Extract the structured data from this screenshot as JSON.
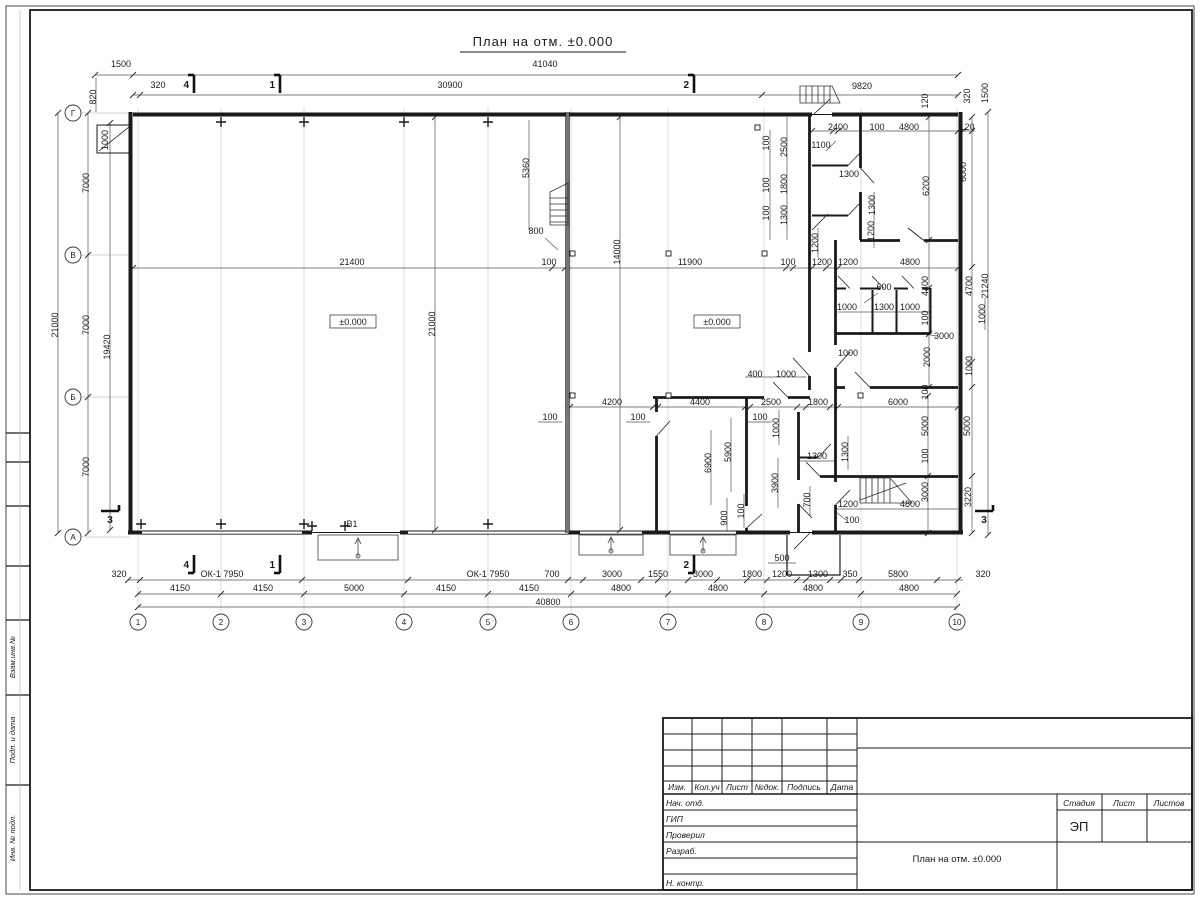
{
  "title": "План на отм. ±0.000",
  "colors": {
    "wall": "#1a1a1a",
    "dim_line": "#555555",
    "axis_line": "#c8c8c8",
    "hatch_wall": "#777777",
    "background": "#ffffff"
  },
  "level_labels": [
    {
      "t": "±0.000",
      "x": 353,
      "y": 324
    },
    {
      "t": "±0.000",
      "x": 717,
      "y": 324
    }
  ],
  "axes": {
    "columns": [
      {
        "label": "1",
        "x": 138
      },
      {
        "label": "2",
        "x": 221
      },
      {
        "label": "3",
        "x": 304
      },
      {
        "label": "4",
        "x": 404
      },
      {
        "label": "5",
        "x": 488
      },
      {
        "label": "6",
        "x": 571
      },
      {
        "label": "7",
        "x": 668
      },
      {
        "label": "8",
        "x": 764
      },
      {
        "label": "9",
        "x": 861
      },
      {
        "label": "10",
        "x": 957
      }
    ],
    "rows": [
      {
        "label": "Г",
        "y": 113
      },
      {
        "label": "В",
        "y": 255
      },
      {
        "label": "Б",
        "y": 397
      },
      {
        "label": "А",
        "y": 537
      }
    ]
  },
  "section_marks": [
    {
      "t": "4",
      "x": 186,
      "y": 86,
      "dir": "t"
    },
    {
      "t": "1",
      "x": 272,
      "y": 86,
      "dir": "t"
    },
    {
      "t": "2",
      "x": 686,
      "y": 86,
      "dir": "t"
    },
    {
      "t": "4",
      "x": 186,
      "y": 566,
      "dir": "b"
    },
    {
      "t": "1",
      "x": 272,
      "y": 566,
      "dir": "b"
    },
    {
      "t": "2",
      "x": 686,
      "y": 566,
      "dir": "b"
    },
    {
      "t": "3",
      "x": 110,
      "y": 514,
      "dir": "l"
    },
    {
      "t": "3",
      "x": 984,
      "y": 514,
      "dir": "r"
    }
  ],
  "dim_labels": [
    {
      "t": "1500",
      "x": 121,
      "y": 67
    },
    {
      "t": "41040",
      "x": 545,
      "y": 67
    },
    {
      "t": "320",
      "x": 158,
      "y": 88
    },
    {
      "t": "30900",
      "x": 450,
      "y": 88
    },
    {
      "t": "9820",
      "x": 862,
      "y": 89
    },
    {
      "t": "820",
      "x": 96,
      "y": 97,
      "r": 1
    },
    {
      "t": "120",
      "x": 928,
      "y": 101,
      "r": 1
    },
    {
      "t": "320",
      "x": 970,
      "y": 96,
      "r": 1
    },
    {
      "t": "1500",
      "x": 988,
      "y": 93,
      "r": 1
    },
    {
      "t": "2400",
      "x": 838,
      "y": 130
    },
    {
      "t": "100",
      "x": 877,
      "y": 130
    },
    {
      "t": "4800",
      "x": 909,
      "y": 130
    },
    {
      "t": "120",
      "x": 967,
      "y": 130
    },
    {
      "t": "1100",
      "x": 821,
      "y": 148
    },
    {
      "t": "100",
      "x": 769,
      "y": 143,
      "r": 1
    },
    {
      "t": "2500",
      "x": 787,
      "y": 147,
      "r": 1
    },
    {
      "t": "1300",
      "x": 849,
      "y": 177
    },
    {
      "t": "100",
      "x": 769,
      "y": 185,
      "r": 1
    },
    {
      "t": "1800",
      "x": 787,
      "y": 184,
      "r": 1
    },
    {
      "t": "100",
      "x": 769,
      "y": 213,
      "r": 1
    },
    {
      "t": "1300",
      "x": 787,
      "y": 215,
      "r": 1
    },
    {
      "t": "6200",
      "x": 929,
      "y": 186,
      "r": 1
    },
    {
      "t": "6000",
      "x": 966,
      "y": 172,
      "r": 1
    },
    {
      "t": "1300",
      "x": 875,
      "y": 205,
      "r": 1
    },
    {
      "t": "1200",
      "x": 874,
      "y": 231,
      "r": 1
    },
    {
      "t": "1200",
      "x": 818,
      "y": 243,
      "r": 1
    },
    {
      "t": "21400",
      "x": 352,
      "y": 265
    },
    {
      "t": "800",
      "x": 536,
      "y": 234
    },
    {
      "t": "100",
      "x": 549,
      "y": 265
    },
    {
      "t": "14000",
      "x": 620,
      "y": 252,
      "r": 1
    },
    {
      "t": "11900",
      "x": 690,
      "y": 265
    },
    {
      "t": "100",
      "x": 788,
      "y": 265
    },
    {
      "t": "1200",
      "x": 822,
      "y": 265
    },
    {
      "t": "1200",
      "x": 848,
      "y": 265
    },
    {
      "t": "4800",
      "x": 910,
      "y": 265
    },
    {
      "t": "5360",
      "x": 529,
      "y": 168,
      "r": 1
    },
    {
      "t": "21000",
      "x": 435,
      "y": 324,
      "r": 1
    },
    {
      "t": "4400",
      "x": 928,
      "y": 286,
      "r": 1
    },
    {
      "t": "4700",
      "x": 972,
      "y": 286,
      "r": 1
    },
    {
      "t": "21240",
      "x": 988,
      "y": 286,
      "r": 1
    },
    {
      "t": "600",
      "x": 884,
      "y": 290
    },
    {
      "t": "1000",
      "x": 847,
      "y": 310
    },
    {
      "t": "1300",
      "x": 884,
      "y": 310
    },
    {
      "t": "1000",
      "x": 910,
      "y": 310
    },
    {
      "t": "100",
      "x": 928,
      "y": 318,
      "r": 1
    },
    {
      "t": "1000",
      "x": 985,
      "y": 314,
      "r": 1
    },
    {
      "t": "3000",
      "x": 944,
      "y": 339
    },
    {
      "t": "2000",
      "x": 930,
      "y": 357,
      "r": 1
    },
    {
      "t": "1000",
      "x": 972,
      "y": 366,
      "r": 1
    },
    {
      "t": "1000",
      "x": 848,
      "y": 356
    },
    {
      "t": "100",
      "x": 928,
      "y": 392,
      "r": 1
    },
    {
      "t": "400",
      "x": 755,
      "y": 377
    },
    {
      "t": "1000",
      "x": 786,
      "y": 377
    },
    {
      "t": "4200",
      "x": 612,
      "y": 405
    },
    {
      "t": "4400",
      "x": 700,
      "y": 405
    },
    {
      "t": "2500",
      "x": 771,
      "y": 405
    },
    {
      "t": "1800",
      "x": 818,
      "y": 405
    },
    {
      "t": "6000",
      "x": 898,
      "y": 405
    },
    {
      "t": "100",
      "x": 550,
      "y": 420
    },
    {
      "t": "100",
      "x": 638,
      "y": 420
    },
    {
      "t": "100",
      "x": 760,
      "y": 420
    },
    {
      "t": "1000",
      "x": 779,
      "y": 428,
      "r": 1
    },
    {
      "t": "5000",
      "x": 928,
      "y": 426,
      "r": 1
    },
    {
      "t": "5000",
      "x": 970,
      "y": 426,
      "r": 1
    },
    {
      "t": "6900",
      "x": 711,
      "y": 463,
      "r": 1
    },
    {
      "t": "5900",
      "x": 731,
      "y": 452,
      "r": 1
    },
    {
      "t": "1300",
      "x": 817,
      "y": 459
    },
    {
      "t": "1300",
      "x": 848,
      "y": 452,
      "r": 1
    },
    {
      "t": "100",
      "x": 928,
      "y": 456,
      "r": 1
    },
    {
      "t": "3900",
      "x": 778,
      "y": 483,
      "r": 1
    },
    {
      "t": "700",
      "x": 810,
      "y": 500,
      "r": 1
    },
    {
      "t": "900",
      "x": 727,
      "y": 518,
      "r": 1
    },
    {
      "t": "100",
      "x": 744,
      "y": 511,
      "r": 1
    },
    {
      "t": "1200",
      "x": 848,
      "y": 507
    },
    {
      "t": "100",
      "x": 852,
      "y": 523
    },
    {
      "t": "4800",
      "x": 910,
      "y": 507
    },
    {
      "t": "3000",
      "x": 928,
      "y": 492,
      "r": 1
    },
    {
      "t": "3220",
      "x": 971,
      "y": 497,
      "r": 1
    },
    {
      "t": "500",
      "x": 782,
      "y": 561
    },
    {
      "t": "7000",
      "x": 89,
      "y": 183,
      "r": 1
    },
    {
      "t": "7000",
      "x": 89,
      "y": 325,
      "r": 1
    },
    {
      "t": "7000",
      "x": 89,
      "y": 467,
      "r": 1
    },
    {
      "t": "21000",
      "x": 58,
      "y": 325,
      "r": 1
    },
    {
      "t": "19420",
      "x": 110,
      "y": 347,
      "r": 1
    },
    {
      "t": "1000",
      "x": 108,
      "y": 140,
      "r": 1
    },
    {
      "t": "В1",
      "x": 352,
      "y": 527
    },
    {
      "t": "320",
      "x": 119,
      "y": 577
    },
    {
      "t": "ОК-1 7950",
      "x": 222,
      "y": 577
    },
    {
      "t": "ОК-1 7950",
      "x": 488,
      "y": 577
    },
    {
      "t": "700",
      "x": 552,
      "y": 577
    },
    {
      "t": "3000",
      "x": 612,
      "y": 577
    },
    {
      "t": "1550",
      "x": 658,
      "y": 577
    },
    {
      "t": "3000",
      "x": 703,
      "y": 577
    },
    {
      "t": "1800",
      "x": 752,
      "y": 577
    },
    {
      "t": "1200",
      "x": 782,
      "y": 577
    },
    {
      "t": "1300",
      "x": 818,
      "y": 577
    },
    {
      "t": "350",
      "x": 850,
      "y": 577
    },
    {
      "t": "5800",
      "x": 898,
      "y": 577
    },
    {
      "t": "320",
      "x": 983,
      "y": 577
    },
    {
      "t": "4150",
      "x": 180,
      "y": 591
    },
    {
      "t": "4150",
      "x": 263,
      "y": 591
    },
    {
      "t": "5000",
      "x": 354,
      "y": 591
    },
    {
      "t": "4150",
      "x": 446,
      "y": 591
    },
    {
      "t": "4150",
      "x": 529,
      "y": 591
    },
    {
      "t": "4800",
      "x": 621,
      "y": 591
    },
    {
      "t": "4800",
      "x": 718,
      "y": 591
    },
    {
      "t": "4800",
      "x": 813,
      "y": 591
    },
    {
      "t": "4800",
      "x": 909,
      "y": 591
    },
    {
      "t": "40800",
      "x": 548,
      "y": 605
    }
  ],
  "titleblock": {
    "header_cols": [
      "Изм.",
      "Кол.уч",
      "Лист",
      "№док.",
      "Подпись",
      "Дата"
    ],
    "staff_rows": [
      "Нач. отд.",
      "ГИП",
      "Проверил",
      "Разраб.",
      "",
      "Н. контр."
    ],
    "stage_cols": [
      "Стадия",
      "Лист",
      "Листов"
    ],
    "stage_value": "ЭП",
    "drawing_name": "План на отм. ±0.000"
  },
  "frame_labels": [
    "Взам.инв.№",
    "Подп. и дата",
    "Инв. № подл."
  ]
}
